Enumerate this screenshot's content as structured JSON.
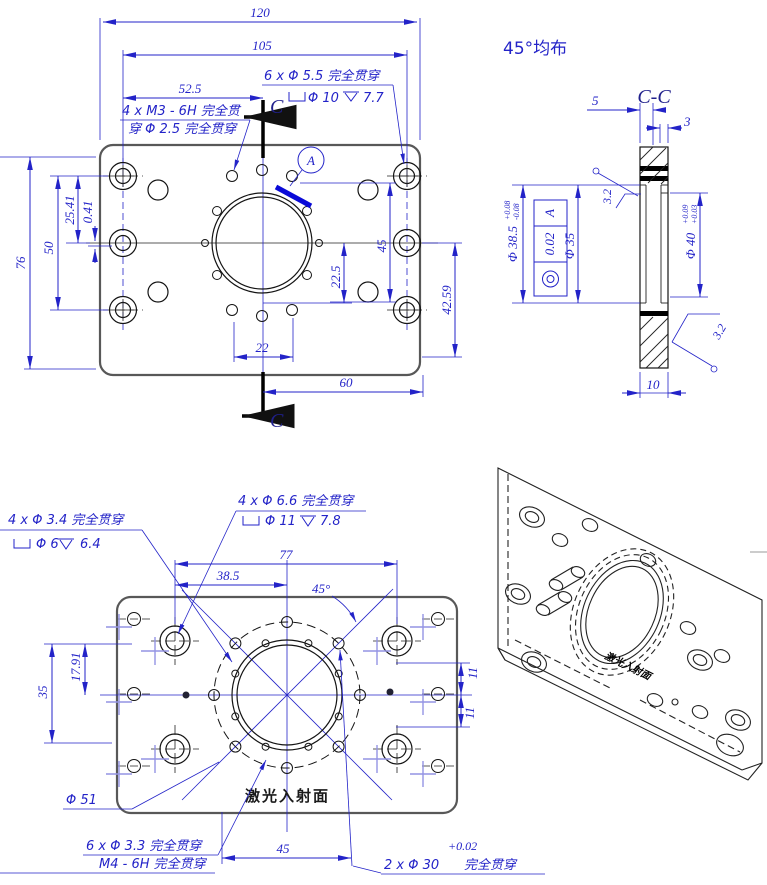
{
  "note_top_right": "45°均布",
  "front": {
    "d120": "120",
    "d105": "105",
    "d525": "52.5",
    "d76": "76",
    "d50": "50",
    "d2541": "25.41",
    "d041": "0.41",
    "d45": "45",
    "d225": "22.5",
    "d4259": "42.59",
    "d22": "22",
    "d60": "60",
    "c6_line1": "6 x Φ 5.5 完全贯穿",
    "c6_cb_dia": "Φ 10",
    "c6_cb_depth": "7.7",
    "cm3_line1": "4 x M3 - 6H 完全贯",
    "cm3_line2": "穿 Φ 2.5 完全贯穿",
    "detail": "A",
    "section_letter_top": "C",
    "section_letter_bottom": "C"
  },
  "section": {
    "title": "C-C",
    "d5": "5",
    "d3": "3",
    "d10": "10",
    "phi385": "Φ 38.5",
    "phi385_up": "+0.08",
    "phi385_dn": "-0.08",
    "fcf_tol": "0.02",
    "fcf_datum": "A",
    "phi35": "Φ 35",
    "phi40": "Φ 40",
    "phi40_up": "+0.09",
    "phi40_dn": "+0.03",
    "finish_left": "3.2",
    "finish_right": "3.2"
  },
  "bottom": {
    "c34_line1": "4 x Φ 3.4 完全贯穿",
    "c34_cb_dia": "Φ 6",
    "c34_cb_depth": "6.4",
    "c66_line1": "4 x Φ 6.6 完全贯穿",
    "c66_cb_dia": "Φ 11",
    "c66_cb_depth": "7.8",
    "d77": "77",
    "d385": "38.5",
    "a45": "45°",
    "d1791": "17.91",
    "d35": "35",
    "d11a": "11",
    "d11b": "11",
    "phi51": "Φ 51",
    "laser": "激光入射面",
    "c33_line1": "6 x Φ 3.3 完全贯穿",
    "c33_line2": "M4 - 6H 完全贯穿",
    "d45b": "45",
    "c30_tol": "+0.02",
    "c30_main": "2 x Φ 30",
    "c30_suffix": "完全贯穿"
  },
  "iso": {
    "stamp": "激光入射面"
  }
}
